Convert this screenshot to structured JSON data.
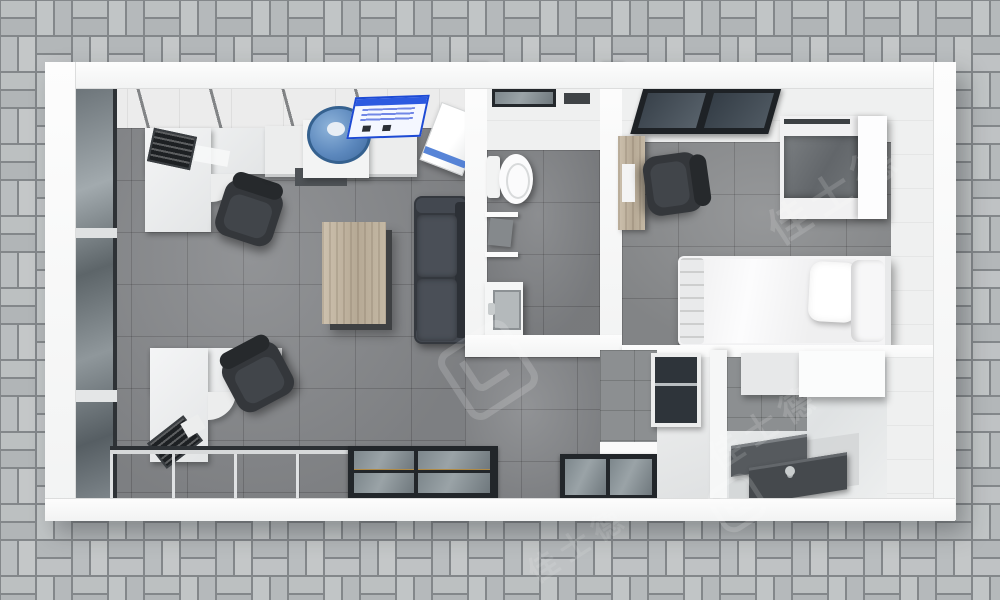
{
  "scene": {
    "type": "3d-floor-plan-render",
    "view": "top-down",
    "description": "Top-down 3D render of a prefab container office/living unit standing on gray basket-weave pavers"
  },
  "watermark": {
    "text": "佳士德"
  },
  "palette": {
    "paver_gray": "#b7babc",
    "mortar_gray": "#82868a",
    "wall_white": "#fafafa",
    "floor_gray": "#85878a",
    "glass_gray": "#79828a",
    "frame_dark": "#22262a",
    "sofa_charcoal": "#4a4f57",
    "table_wood": "#c0b3a0",
    "accent_blue": "#2c5ae0",
    "cooler_blue": "#5c88bd"
  },
  "rooms": {
    "office_area": {
      "items": [
        "glass-partition-wall",
        "l-shaped-desk",
        "office-chair",
        "keyboard",
        "wall-counter",
        "water-dispenser",
        "notice-poster",
        "storage-box",
        "coffee-table",
        "sofa",
        "second-l-shaped-desk",
        "second-office-chair",
        "window-wall"
      ]
    },
    "bathroom": {
      "items": [
        "window",
        "vent",
        "toilet",
        "wall-shelves",
        "toiletry-item",
        "vanity-sink"
      ]
    },
    "bedroom": {
      "items": [
        "ceiling-window",
        "wood-desk",
        "office-chair",
        "wardrobe",
        "single-bed",
        "pillow"
      ]
    },
    "utility_room": {
      "items": [
        "window",
        "partition-wall",
        "wall-cabinets",
        "kitchen-counters",
        "sink-faucet"
      ]
    }
  }
}
